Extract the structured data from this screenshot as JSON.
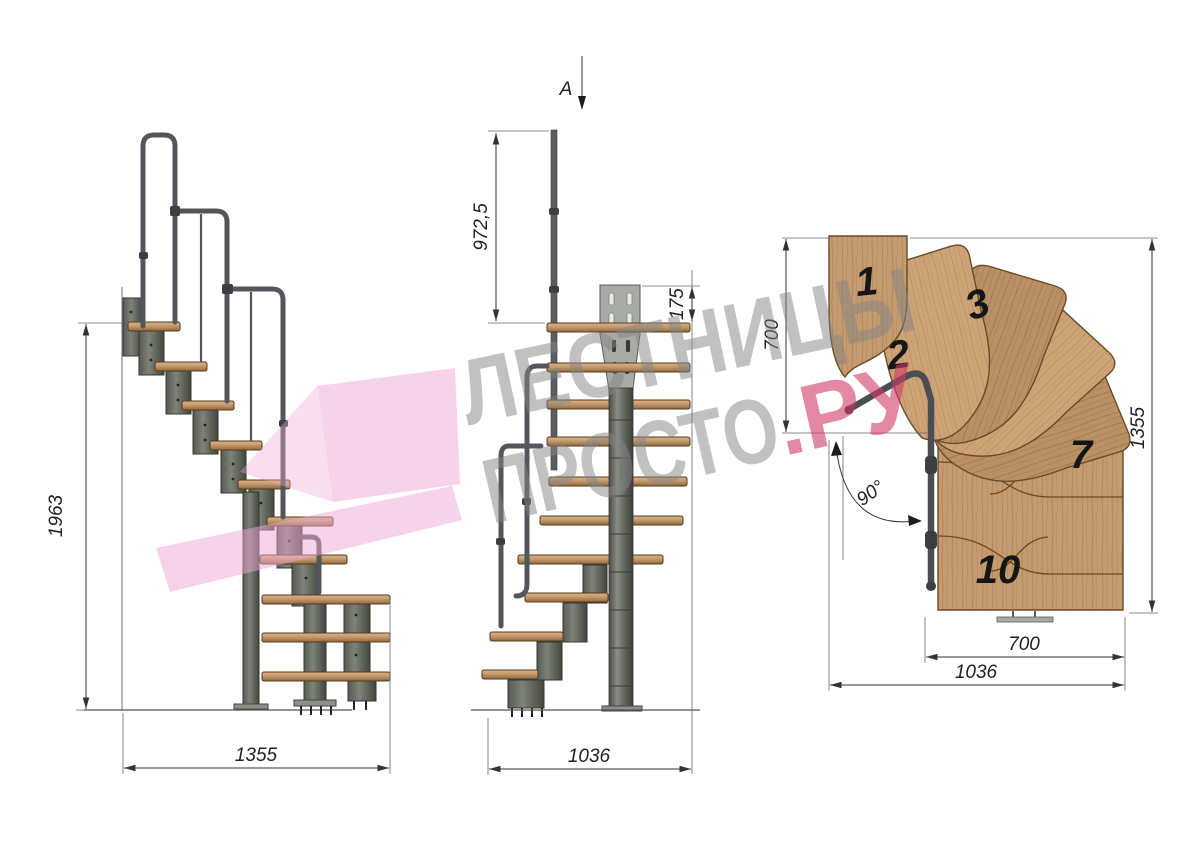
{
  "page": {
    "background": "#ffffff",
    "width": 1200,
    "height": 849
  },
  "watermark": {
    "line1": "ЛЕСТНИЦЫ",
    "line2": "ПРОСТО",
    "line2_accent": ".РУ",
    "text_color": "#858585",
    "accent_color": "#d23b68",
    "shape_color": "#eea8d6"
  },
  "section_arrow": {
    "label": "A"
  },
  "views": {
    "side": {
      "title": "side elevation",
      "dims": {
        "height": "1963",
        "width": "1355"
      }
    },
    "front": {
      "title": "front elevation",
      "dims": {
        "post_height": "972,5",
        "bracket_height": "175",
        "width": "1036"
      }
    },
    "plan": {
      "title": "plan view",
      "dims": {
        "upper_depth": "700",
        "total_depth": "1355",
        "run_width": "700",
        "total_width": "1036"
      },
      "angle_label": "90°",
      "step_labels": [
        "1",
        "2",
        "3",
        "7",
        "10"
      ]
    }
  },
  "materials": {
    "wood": "#c59b6f",
    "wood_dark": "#6a4a28",
    "metal": "#6b6f68",
    "metal_dark": "#3f423e",
    "plate": "#a8aba4",
    "dim_color": "#333333"
  }
}
